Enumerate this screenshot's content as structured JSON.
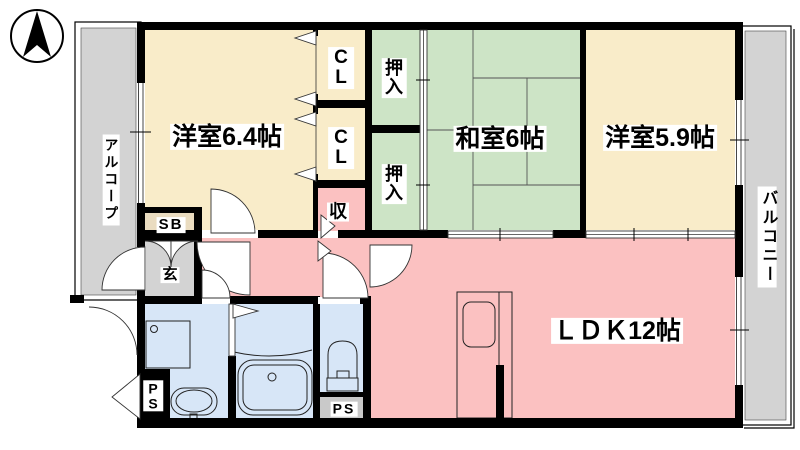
{
  "floorplan": {
    "title": "apartment-floorplan-3LDK",
    "icons": {
      "compass": "north-arrow"
    },
    "labels": {
      "room_west1": "洋室6.4帖",
      "room_japanese": "和室6帖",
      "room_west2": "洋室5.9帖",
      "room_ldk": "ＬＤＫ12帖",
      "closet": "CL",
      "oshiire": "押入",
      "storage": "収",
      "entrance": "玄",
      "shoe_box": "SB",
      "pipe_space": "PS",
      "alcove": "アルコープ",
      "balcony": "バルコニー"
    },
    "colors": {
      "western_room": "#F9ECC9",
      "japanese_room": "#CDE4C6",
      "ldk_pink": "#FBC1C1",
      "water_blue": "#D7E6F7",
      "gray_area": "#D3D3D3",
      "shoebox_tan": "#EADCC0",
      "ps_gray": "#C9C9C9",
      "wall": "#000000"
    }
  }
}
